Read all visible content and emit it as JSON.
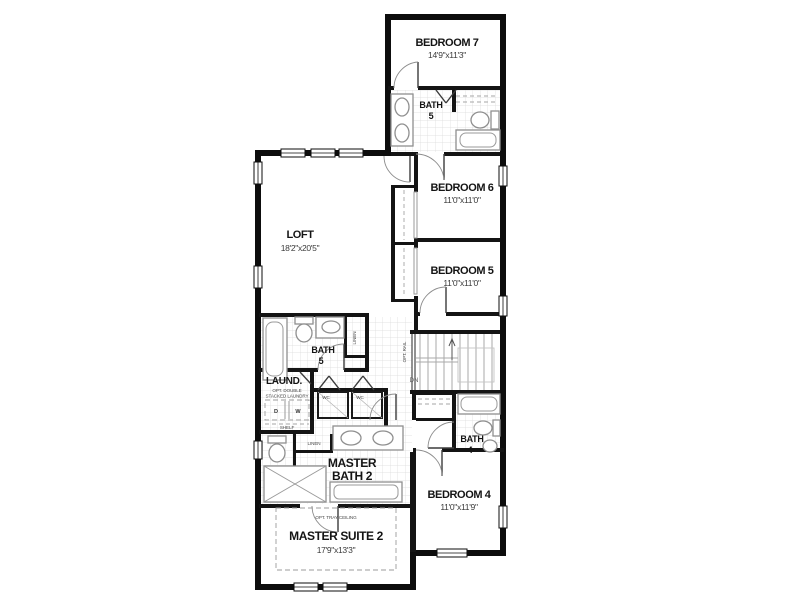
{
  "title": "Second floor plan",
  "colors": {
    "wall": "#0d0d0d",
    "tile_grid": "#dadada",
    "fixture_outline": "#8f8f8f",
    "optional_dashed": "#9b9b9b",
    "background": "#ffffff"
  },
  "rooms": {
    "bedroom7": {
      "name": "BEDROOM 7",
      "dims": "14'9\"x11'3\""
    },
    "bath5_upper": {
      "name": "BATH",
      "number": "5"
    },
    "bedroom6": {
      "name": "BEDROOM 6",
      "dims": "11'0\"x11'0\""
    },
    "loft": {
      "name": "LOFT",
      "dims": "18'2\"x20'5\""
    },
    "bedroom5": {
      "name": "BEDROOM 5",
      "dims": "11'0\"x11'0\""
    },
    "bath5_lower": {
      "name": "BATH",
      "number": "5"
    },
    "laundry": {
      "name": "LAUND.",
      "note_line1": "OPT. DOUBLE",
      "note_line2": "STACKED LAUNDRY",
      "dryer": "D",
      "washer": "W",
      "shelf": "SHELF"
    },
    "master_bath": {
      "name_line1": "MASTER",
      "name_line2": "BATH 2"
    },
    "bath4": {
      "name": "BATH",
      "number": "4"
    },
    "bedroom4": {
      "name": "BEDROOM 4",
      "dims": "11'0\"x11'9\""
    },
    "master_suite": {
      "name": "MASTER SUITE 2",
      "dims": "17'9\"x13'3\"",
      "note": "OPT. TRAY CEILING"
    }
  },
  "closets": {
    "linen_vertical": "LINEN",
    "linen_horizontal": "LINEN",
    "wc_left": "WC",
    "wc_right": "WC"
  },
  "stairs": {
    "down_label": "DN",
    "rail_note": "OPT. RAIL"
  }
}
